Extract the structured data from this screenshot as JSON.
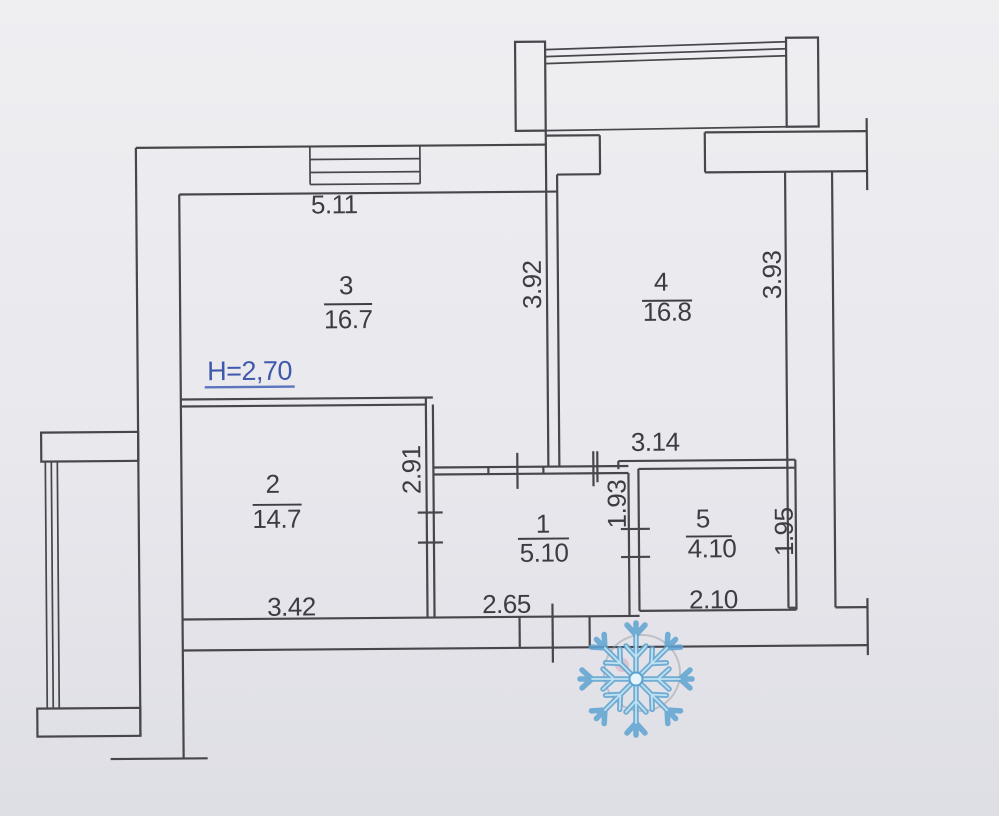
{
  "plan": {
    "height_note": "H=2,70",
    "watermark": "snowflake",
    "rooms": [
      {
        "number": "3",
        "area": "16.7"
      },
      {
        "number": "4",
        "area": "16.8"
      },
      {
        "number": "2",
        "area": "14.7"
      },
      {
        "number": "1",
        "area": "5.10"
      },
      {
        "number": "5",
        "area": "4.10"
      }
    ],
    "dimensions": {
      "room3_width": "5.11",
      "room3_depth": "3.92",
      "room4_depth": "3.93",
      "room2_width": "3.42",
      "room2_depth": "2.91",
      "hall_width": "2.65",
      "hall_depth": "1.93",
      "corridor_width": "3.14",
      "room5_width": "2.10",
      "room5_depth": "1.95"
    },
    "colors": {
      "ink": "#46464b",
      "paper": "#e9e9ee",
      "height_note": "#3f58ab",
      "snowflake": "#5da3d0"
    }
  }
}
